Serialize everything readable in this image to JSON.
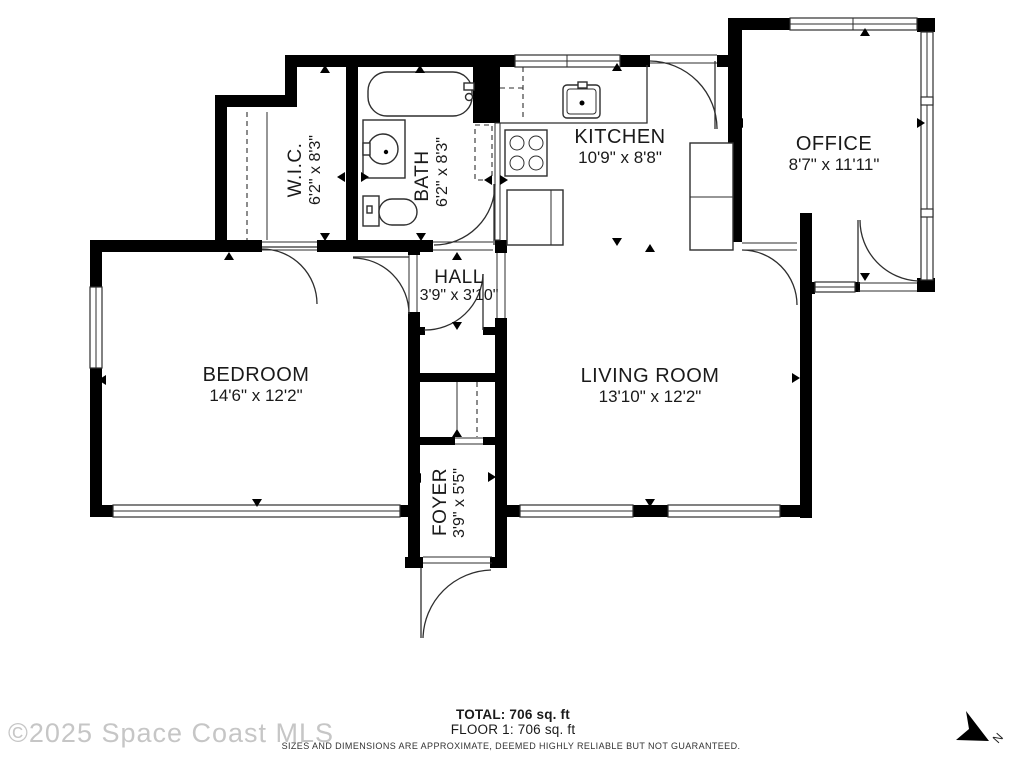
{
  "rooms": [
    {
      "name": "W.I.C.",
      "dims": "6'2\" x 8'3\""
    },
    {
      "name": "BATH",
      "dims": "6'2\" x 8'3\""
    },
    {
      "name": "KITCHEN",
      "dims": "10'9\" x 8'8\""
    },
    {
      "name": "OFFICE",
      "dims": "8'7\" x 11'11\""
    },
    {
      "name": "HALL",
      "dims": "3'9\" x 3'10\""
    },
    {
      "name": "BEDROOM",
      "dims": "14'6\" x 12'2\""
    },
    {
      "name": "LIVING ROOM",
      "dims": "13'10\" x 12'2\""
    },
    {
      "name": "FOYER",
      "dims": "3'9\" x 5'5\""
    }
  ],
  "footer": {
    "total": "TOTAL: 706 sq. ft",
    "floor": "FLOOR 1: 706 sq. ft",
    "disclaimer": "SIZES AND DIMENSIONS ARE APPROXIMATE, DEEMED HIGHLY RELIABLE BUT NOT GUARANTEED."
  },
  "watermark": "©2025 Space Coast MLS",
  "compass": {
    "label": "N"
  },
  "colors": {
    "wall": "#000000",
    "line": "#2e2e2e",
    "text": "#1a1a1a",
    "watermark": "#c6c6c6"
  }
}
